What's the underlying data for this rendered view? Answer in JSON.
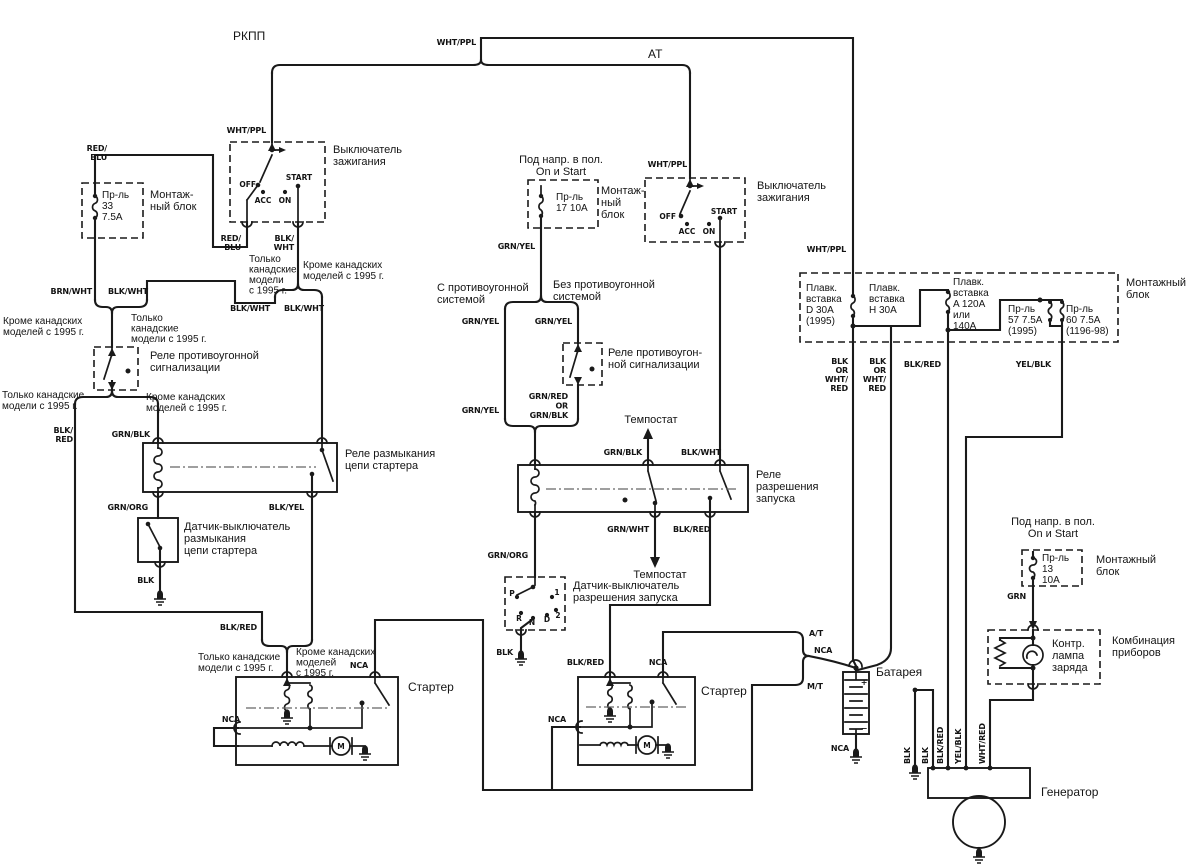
{
  "diagram": {
    "type": "wiring-schematic",
    "language": "ru",
    "ink_color": "#1a1a1a",
    "background_color": "#ffffff",
    "topic": "starting / charging system schematic"
  },
  "labels": [
    {
      "id": "rkpp",
      "text": "РКПП",
      "x": 233,
      "y": 40,
      "anchor": "start",
      "cls": "rul"
    },
    {
      "id": "at-top",
      "text": "АТ",
      "x": 648,
      "y": 58,
      "anchor": "start",
      "cls": "rul"
    },
    {
      "id": "whtppl-bus",
      "text": "WHT/PPL",
      "x": 476,
      "y": 45,
      "anchor": "end",
      "cls": "w"
    },
    {
      "id": "whtppl-ign1",
      "text": "WHT/PPL",
      "x": 266,
      "y": 133,
      "anchor": "end",
      "cls": "w"
    },
    {
      "id": "ign1-title",
      "text": "Выключатель\nзажигания",
      "x": 333,
      "y": 153,
      "anchor": "start",
      "cls": "ru",
      "lh": 12
    },
    {
      "id": "off1",
      "text": "OFF",
      "x": 256,
      "y": 187,
      "anchor": "end",
      "cls": "wl"
    },
    {
      "id": "acc1",
      "text": "ACC",
      "x": 263,
      "y": 203,
      "anchor": "middle",
      "cls": "wl"
    },
    {
      "id": "on1",
      "text": "ON",
      "x": 285,
      "y": 203,
      "anchor": "middle",
      "cls": "wl"
    },
    {
      "id": "start1",
      "text": "START",
      "x": 299,
      "y": 180,
      "anchor": "middle",
      "cls": "wl"
    },
    {
      "id": "redblu-fuse",
      "text": "RED/\nBLU",
      "x": 107,
      "y": 151,
      "anchor": "end",
      "cls": "w",
      "lh": 9
    },
    {
      "id": "fuse33",
      "text": "Пр-ль\n33\n7.5А",
      "x": 102,
      "y": 198,
      "anchor": "start",
      "cls": "rusm",
      "lh": 11
    },
    {
      "id": "mont1",
      "text": "Монтаж-\nный блок",
      "x": 150,
      "y": 198,
      "anchor": "start",
      "cls": "ru",
      "lh": 12
    },
    {
      "id": "redblu-ign1",
      "text": "RED/\nBLU",
      "x": 241,
      "y": 241,
      "anchor": "end",
      "cls": "w",
      "lh": 9
    },
    {
      "id": "blkwht-ign1",
      "text": "BLK/\nWHT",
      "x": 294,
      "y": 241,
      "anchor": "end",
      "cls": "w",
      "lh": 9
    },
    {
      "id": "only-can-1",
      "text": "Только\nканадские\nмодели\nс 1995 г.",
      "x": 249,
      "y": 262,
      "anchor": "start",
      "cls": "rusm",
      "lh": 10.5
    },
    {
      "id": "krome-can-1",
      "text": "Кроме канадских\nмоделей с 1995 г.",
      "x": 303,
      "y": 268,
      "anchor": "start",
      "cls": "rusm",
      "lh": 11
    },
    {
      "id": "blkwht-br-l",
      "text": "BLK/WHT",
      "x": 270,
      "y": 311,
      "anchor": "end",
      "cls": "w"
    },
    {
      "id": "blkwht-br-r",
      "text": "BLK/WHT",
      "x": 284,
      "y": 311,
      "anchor": "start",
      "cls": "w"
    },
    {
      "id": "brnwht",
      "text": "BRN/WHT",
      "x": 92,
      "y": 294,
      "anchor": "end",
      "cls": "w"
    },
    {
      "id": "blkwht-left",
      "text": "BLK/WHT",
      "x": 108,
      "y": 294,
      "anchor": "start",
      "cls": "w"
    },
    {
      "id": "krome-can-2",
      "text": "Кроме канадских\nмоделей с 1995 г.",
      "x": 3,
      "y": 324,
      "anchor": "start",
      "cls": "rusm",
      "lh": 11
    },
    {
      "id": "only-can-2",
      "text": "Только\nканадские\nмодели с 1995 г.",
      "x": 131,
      "y": 321,
      "anchor": "start",
      "cls": "rusm",
      "lh": 10.5
    },
    {
      "id": "relay1-label",
      "text": "Реле противоугонной\nсигнализации",
      "x": 150,
      "y": 359,
      "anchor": "start",
      "cls": "ru",
      "lh": 12
    },
    {
      "id": "only-can-3",
      "text": "Только канадские\nмодели с 1995 г.",
      "x": 2,
      "y": 398,
      "anchor": "start",
      "cls": "rusm",
      "lh": 11
    },
    {
      "id": "krome-can-3",
      "text": "Кроме канадских\nмоделей с 1995 г.",
      "x": 146,
      "y": 400,
      "anchor": "start",
      "cls": "rusm",
      "lh": 11
    },
    {
      "id": "blkred-left",
      "text": "BLK/\nRED",
      "x": 73,
      "y": 433,
      "anchor": "end",
      "cls": "w",
      "lh": 9
    },
    {
      "id": "grnblk-left",
      "text": "GRN/BLK",
      "x": 150,
      "y": 437,
      "anchor": "end",
      "cls": "w"
    },
    {
      "id": "relay2-label",
      "text": "Реле размыкания\nцепи стартера",
      "x": 345,
      "y": 457,
      "anchor": "start",
      "cls": "ru",
      "lh": 12
    },
    {
      "id": "grnorg-left",
      "text": "GRN/ORG",
      "x": 148,
      "y": 510,
      "anchor": "end",
      "cls": "w"
    },
    {
      "id": "blkyel",
      "text": "BLK/YEL",
      "x": 304,
      "y": 510,
      "anchor": "end",
      "cls": "w"
    },
    {
      "id": "sensor1-label",
      "text": "Датчик-выключатель\nразмыкания\nцепи стартера",
      "x": 184,
      "y": 530,
      "anchor": "start",
      "cls": "ru",
      "lh": 12
    },
    {
      "id": "blk-left",
      "text": "BLK",
      "x": 154,
      "y": 583,
      "anchor": "end",
      "cls": "w"
    },
    {
      "id": "blkred-mid",
      "text": "BLK/RED",
      "x": 257,
      "y": 630,
      "anchor": "end",
      "cls": "w"
    },
    {
      "id": "only-can-4",
      "text": "Только канадские\nмодели с 1995 г.",
      "x": 198,
      "y": 660,
      "anchor": "start",
      "cls": "rusm",
      "lh": 11
    },
    {
      "id": "krome-can-4",
      "text": "Кроме канадских\nмоделей\nс 1995 г.",
      "x": 296,
      "y": 655,
      "anchor": "start",
      "cls": "rusm",
      "lh": 10.5
    },
    {
      "id": "nca-st1-top",
      "text": "NCA",
      "x": 368,
      "y": 668,
      "anchor": "end",
      "cls": "w"
    },
    {
      "id": "starter1-label",
      "text": "Стартер",
      "x": 408,
      "y": 691,
      "anchor": "start",
      "cls": "rul"
    },
    {
      "id": "nca-st1-left",
      "text": "NCA",
      "x": 240,
      "y": 722,
      "anchor": "end",
      "cls": "w"
    },
    {
      "id": "podnapr1",
      "text": "Под напр. в пол.\nOn и Start",
      "x": 561,
      "y": 163,
      "anchor": "middle",
      "cls": "ru",
      "lh": 12
    },
    {
      "id": "fuse17",
      "text": "Пр-ль\n17 10А",
      "x": 556,
      "y": 200,
      "anchor": "start",
      "cls": "rusm",
      "lh": 11
    },
    {
      "id": "mont2",
      "text": "Монтаж-\nный\nблок",
      "x": 601,
      "y": 194,
      "anchor": "start",
      "cls": "ru",
      "lh": 12
    },
    {
      "id": "grnyel-0",
      "text": "GRN/YEL",
      "x": 535,
      "y": 249,
      "anchor": "end",
      "cls": "w"
    },
    {
      "id": "s-protiv",
      "text": "С противоугонной\nсистемой",
      "x": 437,
      "y": 291,
      "anchor": "start",
      "cls": "ru",
      "lh": 12
    },
    {
      "id": "bez-protiv",
      "text": "Без противоугонной\nсистемой",
      "x": 553,
      "y": 288,
      "anchor": "start",
      "cls": "ru",
      "lh": 12
    },
    {
      "id": "grnyel-1",
      "text": "GRN/YEL",
      "x": 499,
      "y": 324,
      "anchor": "end",
      "cls": "w"
    },
    {
      "id": "grnyel-2",
      "text": "GRN/YEL",
      "x": 572,
      "y": 324,
      "anchor": "end",
      "cls": "w"
    },
    {
      "id": "relay3-label",
      "text": "Реле противоугон-\nной сигнализации",
      "x": 608,
      "y": 356,
      "anchor": "start",
      "cls": "ru",
      "lh": 12
    },
    {
      "id": "grnred-or",
      "text": "GRN/RED\nOR\nGRN/BLK",
      "x": 568,
      "y": 399,
      "anchor": "end",
      "cls": "w",
      "lh": 9.5
    },
    {
      "id": "grnyel-3",
      "text": "GRN/YEL",
      "x": 499,
      "y": 413,
      "anchor": "end",
      "cls": "w"
    },
    {
      "id": "tempostat-up",
      "text": "Темпостат",
      "x": 651,
      "y": 423,
      "anchor": "middle",
      "cls": "ru"
    },
    {
      "id": "grnblk-mid",
      "text": "GRN/BLK",
      "x": 642,
      "y": 455,
      "anchor": "end",
      "cls": "w"
    },
    {
      "id": "blkwht-mid",
      "text": "BLK/WHT",
      "x": 681,
      "y": 455,
      "anchor": "start",
      "cls": "w"
    },
    {
      "id": "relay4-label",
      "text": "Реле\nразрешения\nзапуска",
      "x": 756,
      "y": 478,
      "anchor": "start",
      "cls": "ru",
      "lh": 12
    },
    {
      "id": "grnwht",
      "text": "GRN/WHT",
      "x": 649,
      "y": 532,
      "anchor": "end",
      "cls": "w"
    },
    {
      "id": "blkred-mid2",
      "text": "BLK/RED",
      "x": 673,
      "y": 532,
      "anchor": "start",
      "cls": "w"
    },
    {
      "id": "tempostat-dn",
      "text": "Темпостат",
      "x": 660,
      "y": 578,
      "anchor": "middle",
      "cls": "ru"
    },
    {
      "id": "grnorg-mid",
      "text": "GRN/ORG",
      "x": 528,
      "y": 558,
      "anchor": "end",
      "cls": "w"
    },
    {
      "id": "sensor2-label",
      "text": "Датчик-выключатель\nразрешения запуска",
      "x": 573,
      "y": 589,
      "anchor": "start",
      "cls": "ru",
      "lh": 12
    },
    {
      "id": "pos-p",
      "text": "P",
      "x": 512,
      "y": 596,
      "anchor": "middle",
      "cls": "wl"
    },
    {
      "id": "pos-1",
      "text": "1",
      "x": 557,
      "y": 595,
      "anchor": "middle",
      "cls": "wl"
    },
    {
      "id": "pos-r",
      "text": "R",
      "x": 519,
      "y": 621,
      "anchor": "middle",
      "cls": "wl"
    },
    {
      "id": "pos-n",
      "text": "N",
      "x": 532,
      "y": 625,
      "anchor": "middle",
      "cls": "wl"
    },
    {
      "id": "pos-d",
      "text": "D",
      "x": 547,
      "y": 622,
      "anchor": "middle",
      "cls": "wl"
    },
    {
      "id": "pos-2",
      "text": "2",
      "x": 558,
      "y": 618,
      "anchor": "middle",
      "cls": "wl"
    },
    {
      "id": "blk-mid",
      "text": "BLK",
      "x": 513,
      "y": 655,
      "anchor": "end",
      "cls": "w"
    },
    {
      "id": "blkred-mid3",
      "text": "BLK/RED",
      "x": 604,
      "y": 665,
      "anchor": "end",
      "cls": "w"
    },
    {
      "id": "nca-mid",
      "text": "NCA",
      "x": 658,
      "y": 665,
      "anchor": "middle",
      "cls": "w"
    },
    {
      "id": "starter2-label",
      "text": "Стартер",
      "x": 701,
      "y": 695,
      "anchor": "start",
      "cls": "rul"
    },
    {
      "id": "nca-st2-left",
      "text": "NCA",
      "x": 566,
      "y": 722,
      "anchor": "end",
      "cls": "w"
    },
    {
      "id": "at-brace",
      "text": "A/T",
      "x": 809,
      "y": 636,
      "anchor": "start",
      "cls": "w"
    },
    {
      "id": "nca-bat",
      "text": "NCA",
      "x": 814,
      "y": 653,
      "anchor": "start",
      "cls": "w"
    },
    {
      "id": "mt-brace",
      "text": "M/T",
      "x": 807,
      "y": 689,
      "anchor": "start",
      "cls": "w"
    },
    {
      "id": "batareya",
      "text": "Батарея",
      "x": 876,
      "y": 676,
      "anchor": "start",
      "cls": "rul"
    },
    {
      "id": "bat-plus",
      "text": "+",
      "x": 864,
      "y": 685,
      "anchor": "middle",
      "cls": "w"
    },
    {
      "id": "bat-minus",
      "text": "−",
      "x": 864,
      "y": 731,
      "anchor": "middle",
      "cls": "w"
    },
    {
      "id": "nca-bat2",
      "text": "NCA",
      "x": 849,
      "y": 751,
      "anchor": "end",
      "cls": "w"
    },
    {
      "id": "whtppl-right",
      "text": "WHT/PPL",
      "x": 846,
      "y": 252,
      "anchor": "end",
      "cls": "w"
    },
    {
      "id": "mont-right",
      "text": "Монтажный\nблок",
      "x": 1126,
      "y": 286,
      "anchor": "start",
      "cls": "ru",
      "lh": 12
    },
    {
      "id": "fuseD",
      "text": "Плавк.\nвставка\nD 30A\n(1995)",
      "x": 806,
      "y": 291,
      "anchor": "start",
      "cls": "rusm",
      "lh": 11
    },
    {
      "id": "fuseH",
      "text": "Плавк.\nвставка\nH 30A",
      "x": 869,
      "y": 291,
      "anchor": "start",
      "cls": "rusm",
      "lh": 11
    },
    {
      "id": "fuseA",
      "text": "Плавк.\nвставка\nA 120A\nили\n140A",
      "x": 953,
      "y": 285,
      "anchor": "start",
      "cls": "rusm",
      "lh": 11
    },
    {
      "id": "fuse57",
      "text": "Пр-ль\n57 7.5A\n(1995)",
      "x": 1008,
      "y": 312,
      "anchor": "start",
      "cls": "rusm",
      "lh": 11
    },
    {
      "id": "fuse60",
      "text": "Пр-ль\n60 7.5A\n(1196-98)",
      "x": 1066,
      "y": 312,
      "anchor": "start",
      "cls": "rusm",
      "lh": 11
    },
    {
      "id": "blk-or-1",
      "text": "BLK\nOR\nWHT/\nRED",
      "x": 848,
      "y": 364,
      "anchor": "end",
      "cls": "w",
      "lh": 9
    },
    {
      "id": "blk-or-2",
      "text": "BLK\nOR\nWHT/\nRED",
      "x": 886,
      "y": 364,
      "anchor": "end",
      "cls": "w",
      "lh": 9
    },
    {
      "id": "blkred-right",
      "text": "BLK/RED",
      "x": 941,
      "y": 367,
      "anchor": "end",
      "cls": "w"
    },
    {
      "id": "yelblk-right",
      "text": "YEL/BLK",
      "x": 1051,
      "y": 367,
      "anchor": "end",
      "cls": "w"
    },
    {
      "id": "podnapr2",
      "text": "Под напр. в пол.\nOn и Start",
      "x": 1053,
      "y": 525,
      "anchor": "middle",
      "cls": "ru",
      "lh": 12
    },
    {
      "id": "fuse13",
      "text": "Пр-ль\n13\n10А",
      "x": 1042,
      "y": 561,
      "anchor": "start",
      "cls": "rusm",
      "lh": 11
    },
    {
      "id": "mont3",
      "text": "Монтажный\nблок",
      "x": 1096,
      "y": 563,
      "anchor": "start",
      "cls": "ru",
      "lh": 12
    },
    {
      "id": "grn",
      "text": "GRN",
      "x": 1026,
      "y": 599,
      "anchor": "end",
      "cls": "w"
    },
    {
      "id": "lamp-label",
      "text": "Контр.\nлампа\nзаряда",
      "x": 1052,
      "y": 647,
      "anchor": "start",
      "cls": "ru",
      "lh": 12
    },
    {
      "id": "kombi",
      "text": "Комбинация\nприборов",
      "x": 1112,
      "y": 644,
      "anchor": "start",
      "cls": "ru",
      "lh": 12
    },
    {
      "id": "generator-label",
      "text": "Генератор",
      "x": 1041,
      "y": 796,
      "anchor": "start",
      "cls": "rul"
    },
    {
      "id": "blk-rot-1",
      "text": "BLK",
      "x": 910,
      "y": 764,
      "anchor": "start",
      "cls": "w",
      "rot": -90
    },
    {
      "id": "blk-rot-2",
      "text": "BLK",
      "x": 928,
      "y": 764,
      "anchor": "start",
      "cls": "w",
      "rot": -90
    },
    {
      "id": "blkred-rot",
      "text": "BLK/RED",
      "x": 943,
      "y": 764,
      "anchor": "start",
      "cls": "w",
      "rot": -90
    },
    {
      "id": "yelblk-rot",
      "text": "YEL/BLK",
      "x": 961,
      "y": 764,
      "anchor": "start",
      "cls": "w",
      "rot": -90
    },
    {
      "id": "whtred-rot",
      "text": "WHT/RED",
      "x": 985,
      "y": 764,
      "anchor": "start",
      "cls": "w",
      "rot": -90
    },
    {
      "id": "whtppl-ign2",
      "text": "WHT/PPL",
      "x": 687,
      "y": 167,
      "anchor": "end",
      "cls": "w"
    },
    {
      "id": "ign2-title",
      "text": "Выключатель\nзажигания",
      "x": 757,
      "y": 189,
      "anchor": "start",
      "cls": "ru",
      "lh": 12
    },
    {
      "id": "off2",
      "text": "OFF",
      "x": 676,
      "y": 219,
      "anchor": "end",
      "cls": "wl"
    },
    {
      "id": "acc2",
      "text": "ACC",
      "x": 687,
      "y": 234,
      "anchor": "middle",
      "cls": "wl"
    },
    {
      "id": "on2",
      "text": "ON",
      "x": 709,
      "y": 234,
      "anchor": "middle",
      "cls": "wl"
    },
    {
      "id": "start2",
      "text": "START",
      "x": 724,
      "y": 214,
      "anchor": "middle",
      "cls": "wl"
    },
    {
      "id": "motor1",
      "text": "M",
      "x": 341,
      "y": 749,
      "anchor": "middle",
      "cls": "wl"
    },
    {
      "id": "motor2",
      "text": "M",
      "x": 647,
      "y": 748,
      "anchor": "middle",
      "cls": "wl"
    }
  ]
}
